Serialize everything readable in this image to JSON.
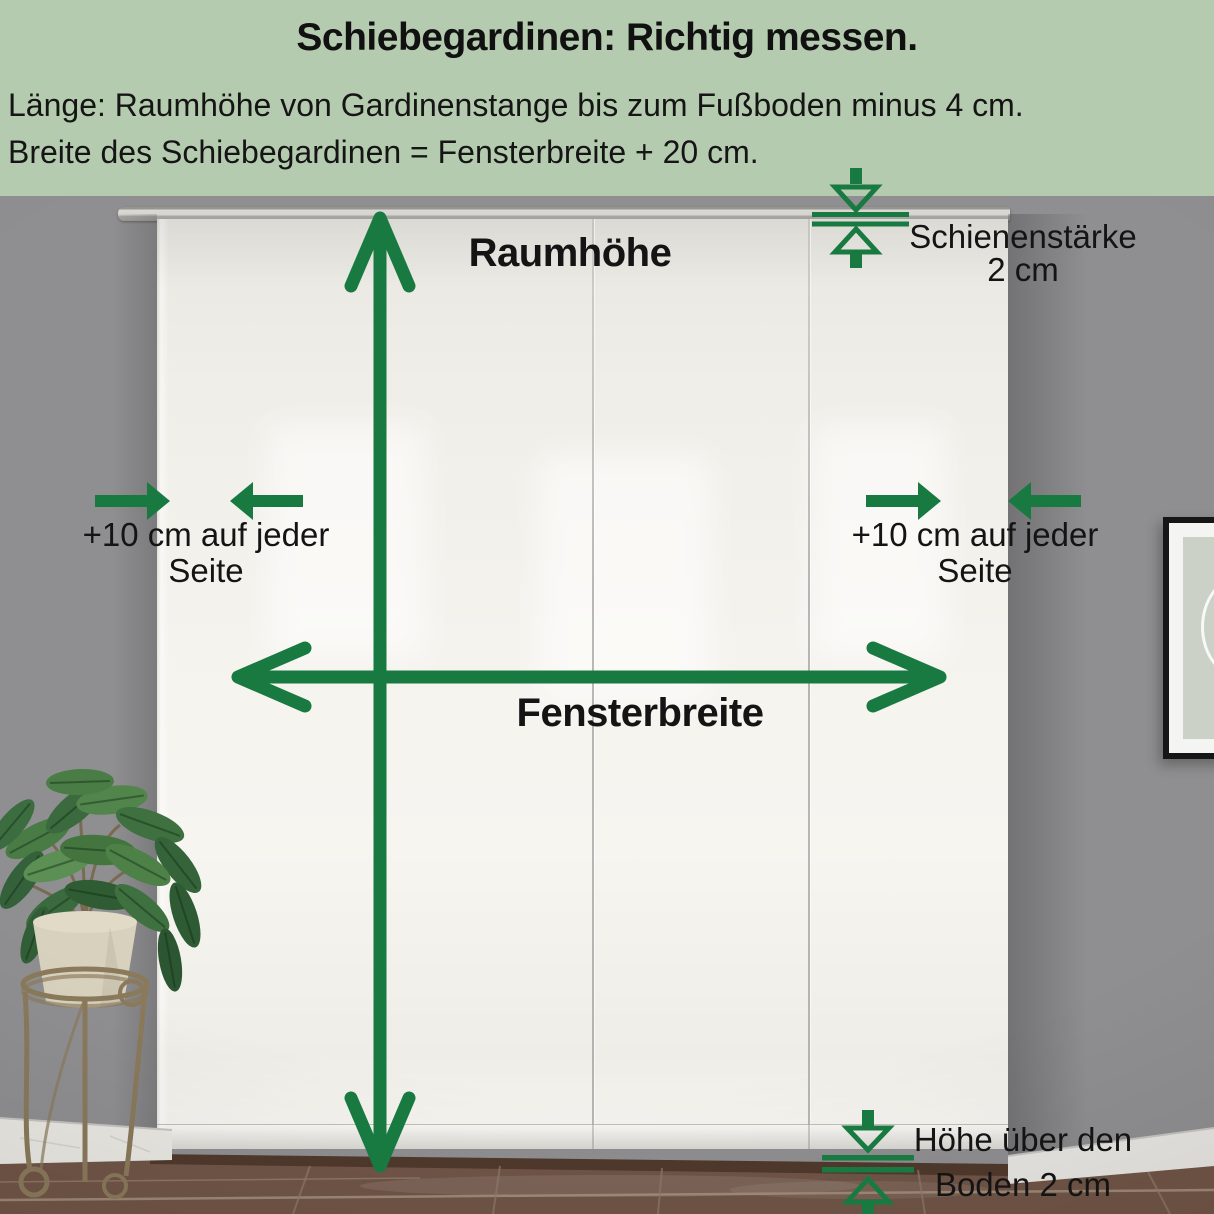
{
  "header": {
    "title": "Schiebegardinen: Richtig messen.",
    "line1": "Länge: Raumhöhe von Gardinenstange bis zum Fußboden minus 4 cm.",
    "line2": "Breite des Schiebegardinen = Fensterbreite + 20 cm."
  },
  "labels": {
    "room_height": "Raumhöhe",
    "window_width": "Fensterbreite",
    "side_left": {
      "line1": "+10 cm auf jeder",
      "line2": "Seite"
    },
    "side_right": {
      "line1": "+10 cm auf jeder",
      "line2": "Seite"
    },
    "rail": {
      "line1": "Schienenstärke",
      "line2": "2 cm"
    },
    "floor": {
      "line1": "Höhe über den",
      "line2": "Boden 2 cm"
    }
  },
  "colors": {
    "header_background": "#b5cbaf",
    "annotation_green": "#187a40",
    "label_text": "#141414",
    "wall_gray": "#8e8e90",
    "curtain_white": "#f2f0ea",
    "floor_brown": "#6f5447"
  }
}
